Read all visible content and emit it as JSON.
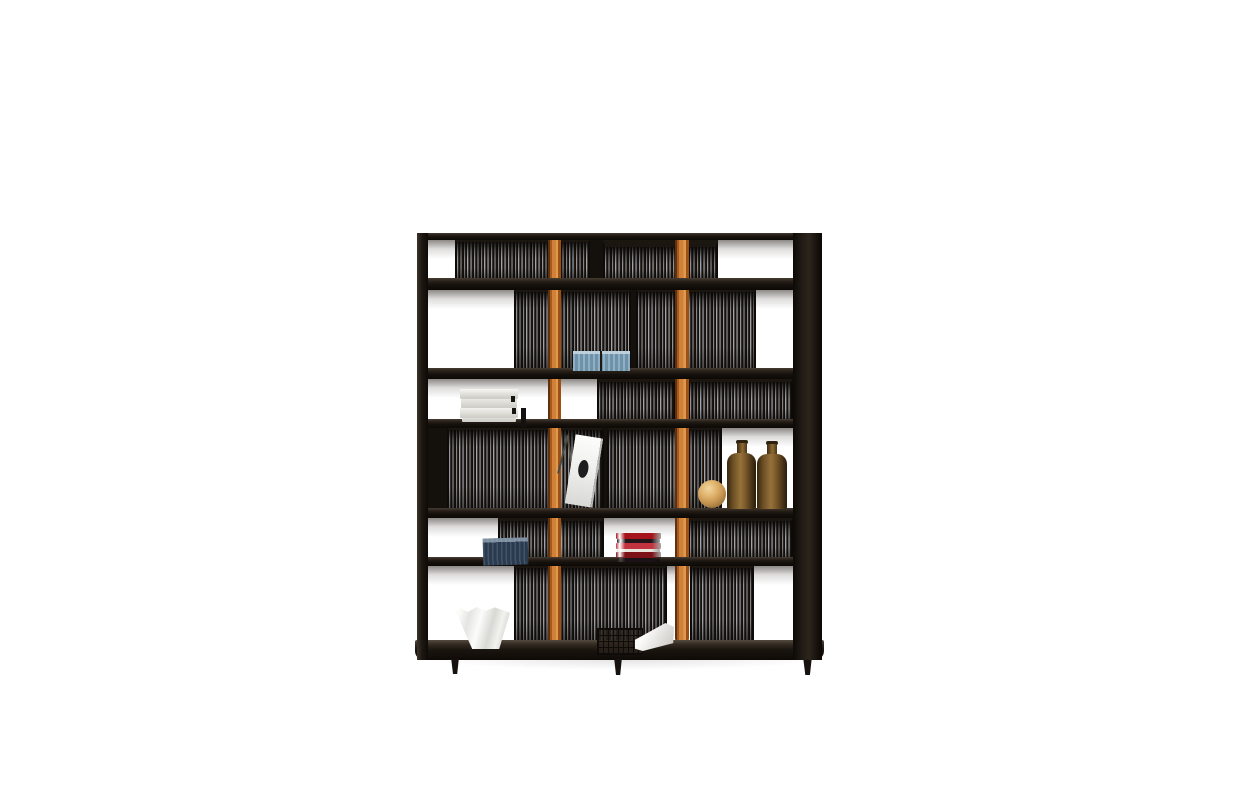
{
  "description": "Product photo: dark wood bookcase with vertical slatted back panels, two orange leather straps, decorative objects, white backdrop",
  "background": "#ffffff",
  "palette": {
    "frame_dark": "#14100c",
    "frame_highlight": "#463c32",
    "slat_light": "#bcbdc1",
    "slat_dark": "#110d09",
    "leather_orange": "#d08138",
    "leather_orange_light": "#e09a50",
    "leather_orange_dark": "#5e3110",
    "amber_glass": "#8a6630",
    "wood_sphere": "#d8ab62",
    "steel_blue_books": "#7fa0b6",
    "navy_books": "#36475c",
    "red_books": "#a6121a",
    "white_objects": "#f6f5f2"
  },
  "scene": {
    "shadow": {
      "x": 430,
      "y": 650,
      "w": 390,
      "h": 20
    },
    "cells": [
      {
        "x": 428,
        "y": 240,
        "w": 27,
        "h": 38
      },
      {
        "x": 718,
        "y": 240,
        "w": 75,
        "h": 38
      },
      {
        "x": 428,
        "y": 290,
        "w": 86,
        "h": 78
      },
      {
        "x": 756,
        "y": 290,
        "w": 37,
        "h": 78
      },
      {
        "x": 428,
        "y": 379,
        "w": 169,
        "h": 40
      },
      {
        "x": 722,
        "y": 428,
        "w": 71,
        "h": 80
      },
      {
        "x": 428,
        "y": 518,
        "w": 70,
        "h": 39
      },
      {
        "x": 604,
        "y": 518,
        "w": 84,
        "h": 39
      },
      {
        "x": 428,
        "y": 566,
        "w": 86,
        "h": 74
      },
      {
        "x": 667,
        "y": 566,
        "w": 23,
        "h": 74
      },
      {
        "x": 754,
        "y": 566,
        "w": 39,
        "h": 74
      }
    ],
    "panels": [
      {
        "x": 455,
        "y": 240,
        "w": 135,
        "h": 38,
        "inset": 2
      },
      {
        "x": 603,
        "y": 240,
        "w": 115,
        "h": 38,
        "inset": 7
      },
      {
        "x": 514,
        "y": 290,
        "w": 117,
        "h": 78,
        "inset": 2
      },
      {
        "x": 636,
        "y": 290,
        "w": 120,
        "h": 78,
        "inset": 2
      },
      {
        "x": 597,
        "y": 379,
        "w": 79,
        "h": 40,
        "inset": 3
      },
      {
        "x": 688,
        "y": 379,
        "w": 105,
        "h": 40,
        "inset": 3
      },
      {
        "x": 447,
        "y": 428,
        "w": 157,
        "h": 80,
        "inset": 2
      },
      {
        "x": 607,
        "y": 428,
        "w": 115,
        "h": 80,
        "inset": 2
      },
      {
        "x": 498,
        "y": 518,
        "w": 106,
        "h": 39,
        "inset": 3
      },
      {
        "x": 688,
        "y": 518,
        "w": 105,
        "h": 39,
        "inset": 3
      },
      {
        "x": 514,
        "y": 566,
        "w": 153,
        "h": 74,
        "inset": 2
      },
      {
        "x": 690,
        "y": 566,
        "w": 64,
        "h": 74,
        "inset": 2
      }
    ],
    "gaps": [
      {
        "x": 590,
        "y": 240,
        "w": 13,
        "h": 38
      },
      {
        "x": 631,
        "y": 290,
        "w": 5,
        "h": 78
      },
      {
        "x": 428,
        "y": 428,
        "w": 19,
        "h": 80
      },
      {
        "x": 604,
        "y": 428,
        "w": 3,
        "h": 80
      }
    ],
    "straps": [
      {
        "name": "leather-strap-left",
        "x": 548,
        "y": 239,
        "w": 13,
        "h": 401
      },
      {
        "name": "leather-strap-right",
        "x": 675,
        "y": 236,
        "w": 14,
        "h": 404
      }
    ],
    "boards": [
      {
        "name": "top-board",
        "x": 417,
        "y": 233,
        "w": 405,
        "h": 7
      },
      {
        "name": "shelf-board-1",
        "x": 417,
        "y": 278,
        "w": 405,
        "h": 12
      },
      {
        "name": "shelf-board-2",
        "x": 417,
        "y": 368,
        "w": 405,
        "h": 11
      },
      {
        "name": "shelf-board-3",
        "x": 417,
        "y": 419,
        "w": 405,
        "h": 9
      },
      {
        "name": "shelf-board-4",
        "x": 417,
        "y": 508,
        "w": 405,
        "h": 10
      },
      {
        "name": "shelf-board-5",
        "x": 417,
        "y": 557,
        "w": 405,
        "h": 9
      },
      {
        "name": "bottom-board",
        "x": 415,
        "y": 640,
        "w": 409,
        "h": 20,
        "bottom": true
      }
    ],
    "posts": [
      {
        "name": "left-post",
        "x": 417,
        "y": 233,
        "w": 11,
        "h": 427
      },
      {
        "name": "right-post",
        "x": 793,
        "y": 233,
        "w": 29,
        "h": 427
      }
    ],
    "feet": [
      {
        "x": 450,
        "y": 659,
        "w": 10,
        "h": 15
      },
      {
        "x": 613,
        "y": 659,
        "w": 10,
        "h": 16
      },
      {
        "x": 802,
        "y": 659,
        "w": 11,
        "h": 16
      }
    ],
    "objects": [
      {
        "type": "white-book-stack",
        "name": "white-books",
        "x": 460,
        "y": 389,
        "w": 58,
        "h": 33
      },
      {
        "type": "black-stick",
        "name": "black-bookend",
        "x": 521,
        "y": 408,
        "w": 5,
        "h": 19
      },
      {
        "type": "blue-book-row",
        "name": "blue-books",
        "x": 573,
        "y": 351,
        "w": 57,
        "h": 20
      },
      {
        "type": "leaning-magazine",
        "name": "leaning-magazine",
        "x": 556,
        "y": 434,
        "w": 46,
        "h": 72
      },
      {
        "type": "wood-sphere",
        "name": "wooden-sphere",
        "x": 698,
        "y": 480,
        "w": 28,
        "h": 28
      },
      {
        "type": "amber-bottle",
        "name": "amber-bottle-1",
        "x": 727,
        "y": 440,
        "w": 29,
        "h": 69
      },
      {
        "type": "amber-bottle",
        "name": "amber-bottle-2",
        "x": 757,
        "y": 441,
        "w": 30,
        "h": 68
      },
      {
        "type": "navy-book-row",
        "name": "navy-books",
        "x": 483,
        "y": 538,
        "w": 45,
        "h": 27
      },
      {
        "type": "red-book-stack",
        "name": "red-books",
        "x": 616,
        "y": 533,
        "w": 45,
        "h": 29,
        "stripes": [
          "#a6121a",
          "#23151a",
          "#c2333d",
          "#e9e4dc",
          "#7c1218",
          "#1a1216"
        ],
        "stripe_heights": [
          6,
          4,
          6,
          3,
          6,
          4
        ]
      },
      {
        "type": "white-bowl",
        "name": "white-bowl",
        "x": 456,
        "y": 607,
        "w": 54,
        "h": 42
      },
      {
        "type": "wire-basket",
        "name": "wire-basket",
        "x": 597,
        "y": 628,
        "w": 44,
        "h": 25
      },
      {
        "type": "white-book-flat",
        "name": "white-book",
        "x": 635,
        "y": 623,
        "w": 39,
        "h": 28
      }
    ]
  }
}
